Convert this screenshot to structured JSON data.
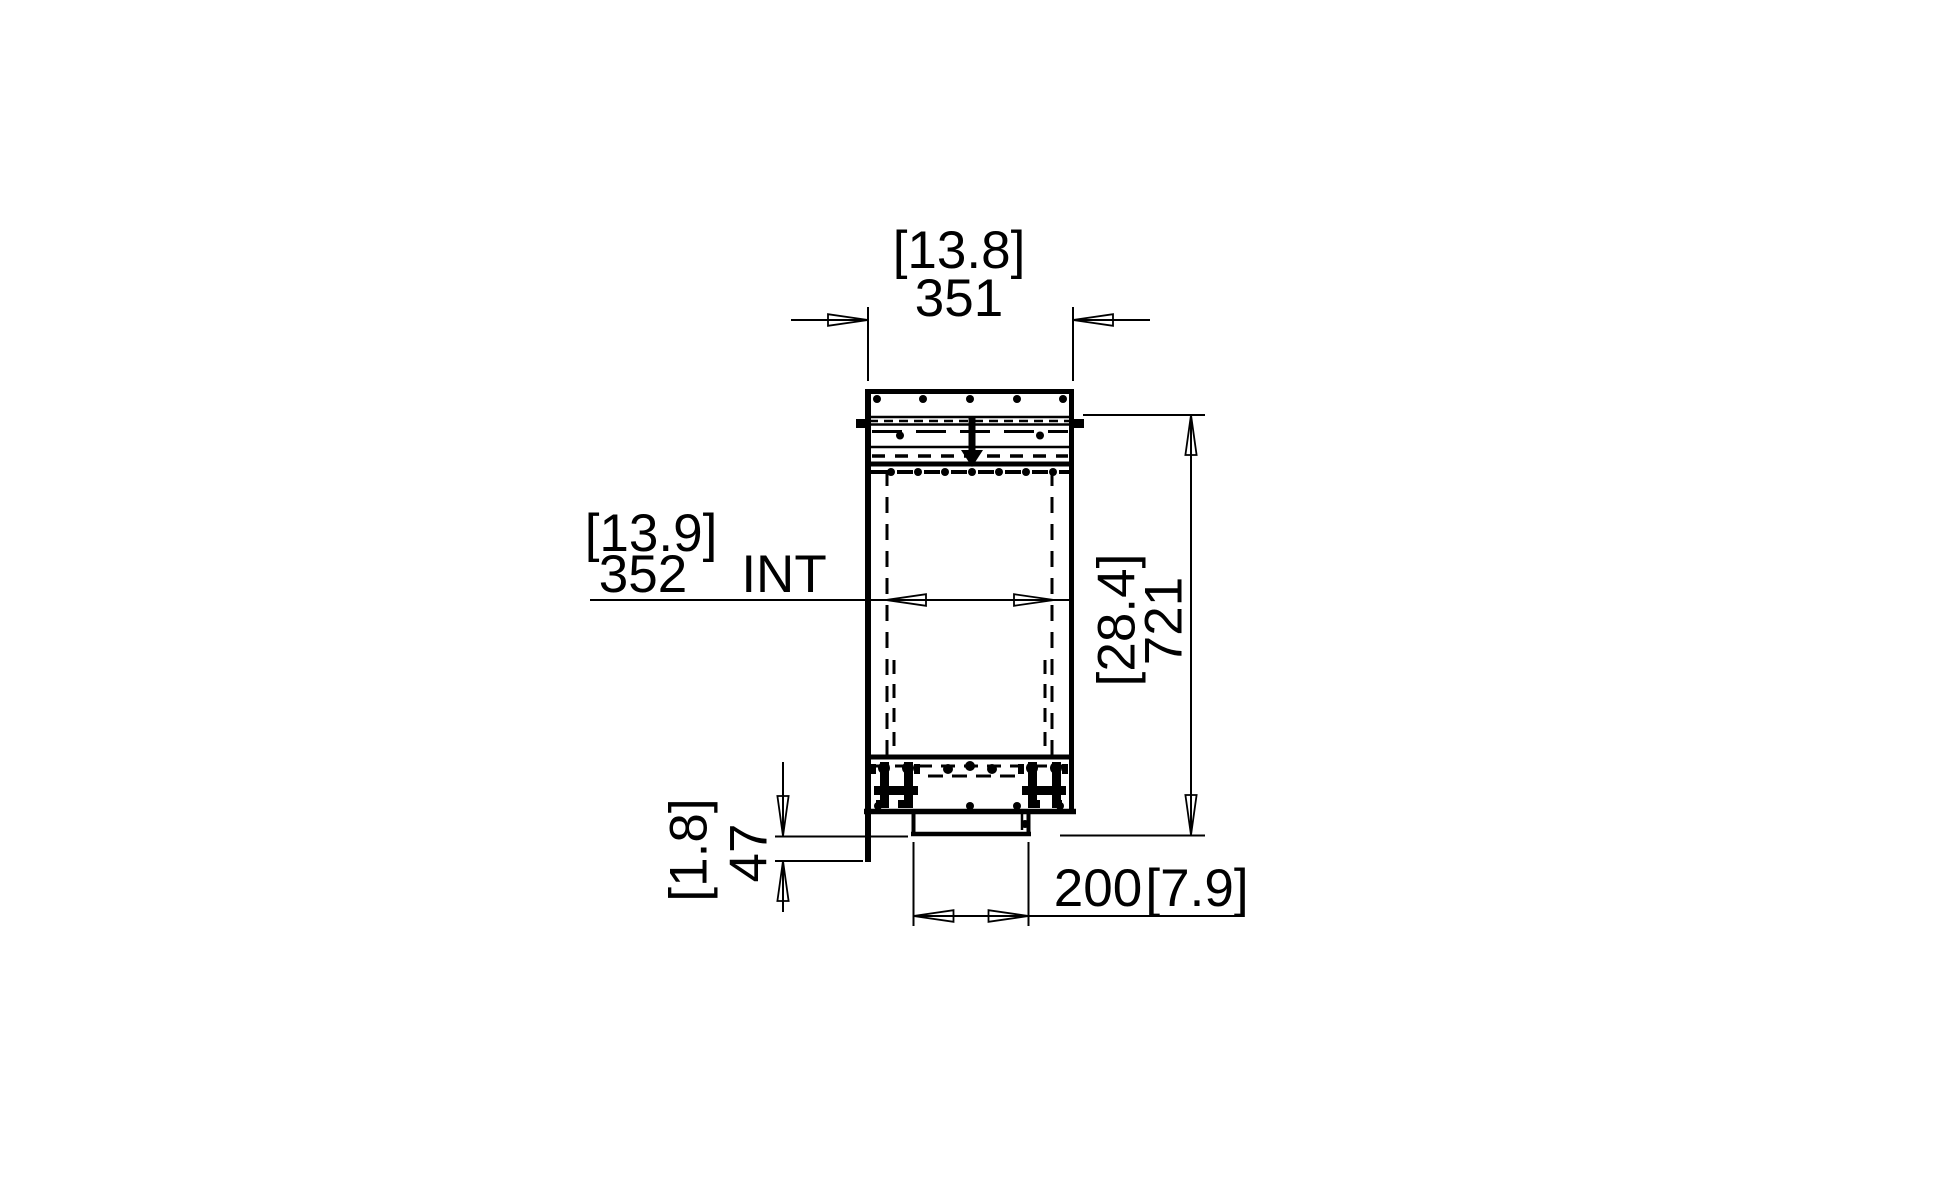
{
  "colors": {
    "ink": "#000000",
    "background": "#ffffff"
  },
  "dimensions": {
    "top_width": {
      "inches": "[13.8]",
      "mm": "351"
    },
    "internal_width": {
      "inches": "[13.9]",
      "mm": "352",
      "suffix": "INT"
    },
    "overall_height": {
      "inches": "[28.4]",
      "mm": "721"
    },
    "base_drop": {
      "inches": "[1.8]",
      "mm": "47"
    },
    "duct_width": {
      "mm": "200",
      "inches": "[7.9]"
    }
  }
}
